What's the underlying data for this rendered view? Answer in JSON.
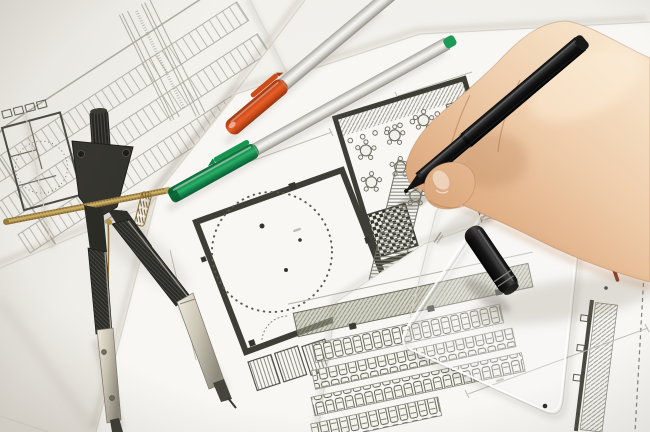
{
  "scene": {
    "type": "photograph",
    "description": "Close-up of a right hand drawing with a black fineliner on overlapping architectural floor plans; a drafting compass, an orange-capped pen, a green-capped pen, a black pen cap, a round stamp imprint and a transparent set square rest on the blueprint sheets."
  },
  "objects": {
    "hand": {
      "label": "right hand holding drawing pen",
      "skin_tone": "#ecc9a6"
    },
    "drawing_pen": {
      "label": "black fineliner pen",
      "body_color": "#141412"
    },
    "pen_cap": {
      "label": "black pen cap",
      "body_color": "#101010",
      "ring_color": "#8f8f88"
    },
    "compass": {
      "label": "drafting compass",
      "body_color": "#30302b",
      "screw_rod_color": "#b3924c",
      "leg_metal_color": "#c9c4b4"
    },
    "orange_pen": {
      "label": "orange-capped pen",
      "cap_color": "#cf4c1a",
      "body_color": "#dedcd7"
    },
    "green_pen": {
      "label": "green-capped pen",
      "cap_color": "#17944f",
      "end_plug_color": "#1d9a55",
      "body_color": "#dedcd7"
    },
    "set_square": {
      "label": "transparent set square",
      "tint": "rgba(250,250,248,0.3)",
      "hole_color": "#2e2e2a"
    },
    "stamp": {
      "label": "round drawing stamp imprint",
      "ink_color": "#5b5b51"
    },
    "blueprints": {
      "label": "architectural drawing sheets",
      "paper_color": "#f8f7f4",
      "wall_color": "#3e3e36",
      "faint_line_color": "#b7b4ab",
      "hatch_color": "#8f8f82",
      "features": [
        "parking site plan top left",
        "floor plan with dotted circle center",
        "restaurant plan with round tables under hand",
        "parking rows with drawn cars bottom right",
        "hatched wall strips",
        "dimension lines with illegible annotations",
        "small red plan marking"
      ]
    }
  }
}
